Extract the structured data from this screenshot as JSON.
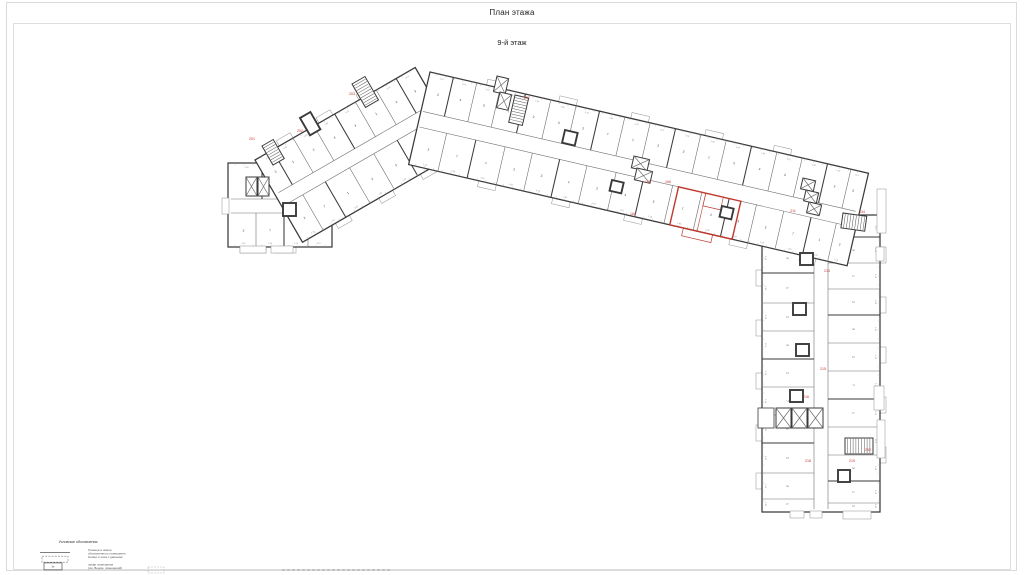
{
  "title": "План этажа",
  "subtitle": "9-й этаж",
  "colors": {
    "wall": "#3a3a3a",
    "part": "#6e6e6e",
    "thin": "#9a9a9a",
    "corridor": "#707070",
    "digit": "#2b2b2b",
    "dim": "#8c8c8c",
    "red": "#c1392e",
    "frame": "#dadada"
  },
  "plan": {
    "digit_cycle": [
      "1",
      "2",
      "3",
      "2",
      "7",
      "1",
      "2",
      "3",
      "1",
      "2",
      "4",
      "3"
    ],
    "dim_cycle": [
      "2.45",
      "3.60",
      "1.82",
      "4.15",
      "2.90",
      "3.25",
      "12.6",
      "2.18"
    ],
    "bands": [
      {
        "id": "west-end-block",
        "x": 228,
        "y": 163,
        "angle": 0,
        "len": 104,
        "w": 84,
        "corridor": [
          36,
          50
        ],
        "inset0": 3,
        "inset1": 3,
        "parts_top": [
          34,
          66
        ],
        "parts_bottom": [
          28,
          56,
          80
        ],
        "balconies_top": [],
        "balconies_bottom": [
          {
            "s": 12,
            "l": 26
          },
          {
            "s": 46,
            "l": 22
          }
        ]
      },
      {
        "id": "left-wing",
        "x": 255,
        "y": 160,
        "angle": -30,
        "len": 185,
        "w": 95,
        "corridor": [
          40,
          54
        ],
        "inset0": 4,
        "inset1": 2,
        "parts_top": [
          20,
          44,
          68,
          92,
          116,
          140,
          163
        ],
        "parts_bottom": [
          24,
          50,
          78,
          106,
          133,
          160
        ],
        "balconies_top": [
          {
            "s": 28,
            "l": 16
          },
          {
            "s": 74,
            "l": 16
          },
          {
            "s": 120,
            "l": 16
          }
        ],
        "balconies_bottom": [
          {
            "s": 38,
            "l": 16
          },
          {
            "s": 88,
            "l": 16
          },
          {
            "s": 136,
            "l": 16
          }
        ]
      },
      {
        "id": "right-wing",
        "x": 880,
        "y": 215,
        "angle": 90,
        "len": 297,
        "w": 118,
        "corridor": [
          52,
          66
        ],
        "inset0": 3,
        "inset1": 3,
        "parts_top": [
          22,
          48,
          74,
          100,
          128,
          156,
          184,
          212,
          240,
          266,
          288
        ],
        "parts_bottom": [
          28,
          58,
          88,
          116,
          144,
          172,
          200,
          228,
          258,
          284
        ],
        "balconies_top": [
          {
            "s": 32,
            "l": 16
          },
          {
            "s": 82,
            "l": 16
          },
          {
            "s": 132,
            "l": 16
          },
          {
            "s": 182,
            "l": 16
          },
          {
            "s": 232,
            "l": 16
          }
        ],
        "balconies_bottom": [
          {
            "s": 55,
            "l": 16
          },
          {
            "s": 105,
            "l": 16
          },
          {
            "s": 158,
            "l": 16
          },
          {
            "s": 210,
            "l": 16
          },
          {
            "s": 258,
            "l": 16
          }
        ]
      },
      {
        "id": "center-wing",
        "x": 430,
        "y": 72,
        "angle": 13,
        "len": 450,
        "w": 95,
        "corridor": [
          40,
          56
        ],
        "inset0": 2,
        "inset1": 4,
        "parts_top": [
          24,
          48,
          72,
          98,
          124,
          150,
          174,
          200,
          226,
          252,
          278,
          304,
          330,
          356,
          382,
          408,
          432
        ],
        "parts_bottom": [
          30,
          60,
          90,
          118,
          146,
          174,
          204,
          232,
          262,
          292,
          320,
          348,
          376,
          404,
          430
        ],
        "balconies_top": [
          {
            "s": 58,
            "l": 18
          },
          {
            "s": 132,
            "l": 18
          },
          {
            "s": 206,
            "l": 18
          },
          {
            "s": 282,
            "l": 18
          },
          {
            "s": 352,
            "l": 18
          }
        ],
        "balconies_bottom": [
          {
            "s": 72,
            "l": 18
          },
          {
            "s": 148,
            "l": 18
          },
          {
            "s": 222,
            "l": 18
          },
          {
            "s": 330,
            "l": 18
          },
          {
            "s": 402,
            "l": 16
          }
        ]
      }
    ],
    "red_unit": {
      "band": "center-wing",
      "x": 268,
      "y": 56,
      "w": 64,
      "h": 39,
      "inner_lines": [
        [
          296,
          56,
          296,
          95
        ],
        [
          296,
          69,
          314,
          69
        ]
      ],
      "inner_rect": {
        "x": 296,
        "y": 56,
        "w": 18,
        "h": 13
      },
      "balcony": {
        "x": 282,
        "y": 95,
        "w": 30,
        "h": 8
      }
    },
    "cores": [
      {
        "x": 246,
        "y": 177,
        "w": 11,
        "h": 19,
        "angle": 0,
        "type": "x"
      },
      {
        "x": 258,
        "y": 177,
        "w": 11,
        "h": 19,
        "angle": 0,
        "type": "x"
      },
      {
        "x": 283,
        "y": 203,
        "w": 13,
        "h": 13,
        "angle": 0,
        "type": "thick"
      },
      {
        "x": 262,
        "y": 146,
        "w": 13,
        "h": 22,
        "angle": -30,
        "type": "stair",
        "dir": "h"
      },
      {
        "x": 300,
        "y": 118,
        "w": 12,
        "h": 20,
        "angle": -30,
        "type": "thick"
      },
      {
        "x": 352,
        "y": 84,
        "w": 15,
        "h": 27,
        "angle": -30,
        "type": "stair",
        "dir": "h"
      },
      {
        "x": 497,
        "y": 76,
        "w": 12,
        "h": 16,
        "angle": 13,
        "type": "x"
      },
      {
        "x": 500,
        "y": 92,
        "w": 12,
        "h": 16,
        "angle": 13,
        "type": "x"
      },
      {
        "x": 515,
        "y": 95,
        "w": 14,
        "h": 28,
        "angle": 13,
        "type": "stair",
        "dir": "h"
      },
      {
        "x": 565,
        "y": 130,
        "w": 13,
        "h": 13,
        "angle": 13,
        "type": "thick"
      },
      {
        "x": 634,
        "y": 156,
        "w": 16,
        "h": 12,
        "angle": 13,
        "type": "x"
      },
      {
        "x": 637,
        "y": 168,
        "w": 16,
        "h": 12,
        "angle": 13,
        "type": "x"
      },
      {
        "x": 612,
        "y": 180,
        "w": 12,
        "h": 11,
        "angle": 13,
        "type": "thick"
      },
      {
        "x": 722,
        "y": 206,
        "w": 12,
        "h": 11,
        "angle": 13,
        "type": "thick"
      },
      {
        "x": 803,
        "y": 178,
        "w": 13,
        "h": 11,
        "angle": 13,
        "type": "x"
      },
      {
        "x": 806,
        "y": 190,
        "w": 13,
        "h": 11,
        "angle": 13,
        "type": "x"
      },
      {
        "x": 809,
        "y": 202,
        "w": 13,
        "h": 11,
        "angle": 13,
        "type": "x"
      },
      {
        "x": 843,
        "y": 213,
        "w": 24,
        "h": 15,
        "angle": 8,
        "type": "stair",
        "dir": "v"
      },
      {
        "x": 800,
        "y": 253,
        "w": 13,
        "h": 12,
        "angle": 0,
        "type": "thick"
      },
      {
        "x": 793,
        "y": 303,
        "w": 13,
        "h": 12,
        "angle": 0,
        "type": "thick"
      },
      {
        "x": 796,
        "y": 344,
        "w": 13,
        "h": 12,
        "angle": 0,
        "type": "thick"
      },
      {
        "x": 790,
        "y": 390,
        "w": 13,
        "h": 12,
        "angle": 0,
        "type": "thick"
      },
      {
        "x": 758,
        "y": 408,
        "w": 16,
        "h": 20,
        "angle": 0,
        "type": "plain"
      },
      {
        "x": 776,
        "y": 408,
        "w": 15,
        "h": 20,
        "angle": 0,
        "type": "x"
      },
      {
        "x": 792,
        "y": 408,
        "w": 15,
        "h": 20,
        "angle": 0,
        "type": "x"
      },
      {
        "x": 808,
        "y": 408,
        "w": 15,
        "h": 20,
        "angle": 0,
        "type": "x"
      },
      {
        "x": 845,
        "y": 438,
        "w": 28,
        "h": 16,
        "angle": 0,
        "type": "stair",
        "dir": "v"
      },
      {
        "x": 838,
        "y": 470,
        "w": 12,
        "h": 12,
        "angle": 0,
        "type": "thick"
      }
    ],
    "annexes": [
      {
        "x": 877,
        "y": 189,
        "w": 9,
        "h": 44
      },
      {
        "x": 876,
        "y": 247,
        "w": 8,
        "h": 14
      },
      {
        "x": 874,
        "y": 386,
        "w": 10,
        "h": 24
      },
      {
        "x": 877,
        "y": 420,
        "w": 8,
        "h": 38
      },
      {
        "x": 790,
        "y": 511,
        "w": 14,
        "h": 7
      },
      {
        "x": 810,
        "y": 511,
        "w": 12,
        "h": 7
      },
      {
        "x": 843,
        "y": 511,
        "w": 28,
        "h": 8
      },
      {
        "x": 222,
        "y": 198,
        "w": 7,
        "h": 16
      },
      {
        "x": 240,
        "y": 246,
        "w": 26,
        "h": 7
      },
      {
        "x": 271,
        "y": 246,
        "w": 22,
        "h": 7
      }
    ],
    "red_labels": [
      {
        "x": 252,
        "y": 140,
        "t": "201"
      },
      {
        "x": 300,
        "y": 132,
        "t": "202"
      },
      {
        "x": 352,
        "y": 95,
        "t": "203"
      },
      {
        "x": 527,
        "y": 99,
        "t": "207"
      },
      {
        "x": 633,
        "y": 215,
        "t": "164"
      },
      {
        "x": 648,
        "y": 183,
        "t": "165"
      },
      {
        "x": 668,
        "y": 183,
        "t": "166"
      },
      {
        "x": 793,
        "y": 212,
        "t": "211"
      },
      {
        "x": 862,
        "y": 213,
        "t": "434"
      },
      {
        "x": 827,
        "y": 272,
        "t": "213"
      },
      {
        "x": 823,
        "y": 370,
        "t": "215"
      },
      {
        "x": 806,
        "y": 398,
        "t": "216"
      },
      {
        "x": 808,
        "y": 462,
        "t": "218"
      },
      {
        "x": 852,
        "y": 462,
        "t": "219"
      },
      {
        "x": 868,
        "y": 451,
        "t": "292"
      }
    ],
    "bottom_marks": [
      {
        "type": "box",
        "x": 148,
        "y": 567,
        "w": 16,
        "h": 6
      },
      {
        "type": "dots",
        "x": 282,
        "y": 570,
        "l": 110
      }
    ]
  },
  "legend": {
    "title": "Условные обозначения",
    "items": [
      {
        "symbol": "line",
        "lines": [
          "Граница и номер",
          "обозначенного помещения"
        ]
      },
      {
        "symbol": "dashed",
        "lines": [
          "Номер и зона с данными"
        ]
      },
      {
        "symbol": "box",
        "box_label": "2н",
        "lines": [
          "шифр помещения",
          "(см. Ведом. помещений)"
        ]
      }
    ]
  }
}
